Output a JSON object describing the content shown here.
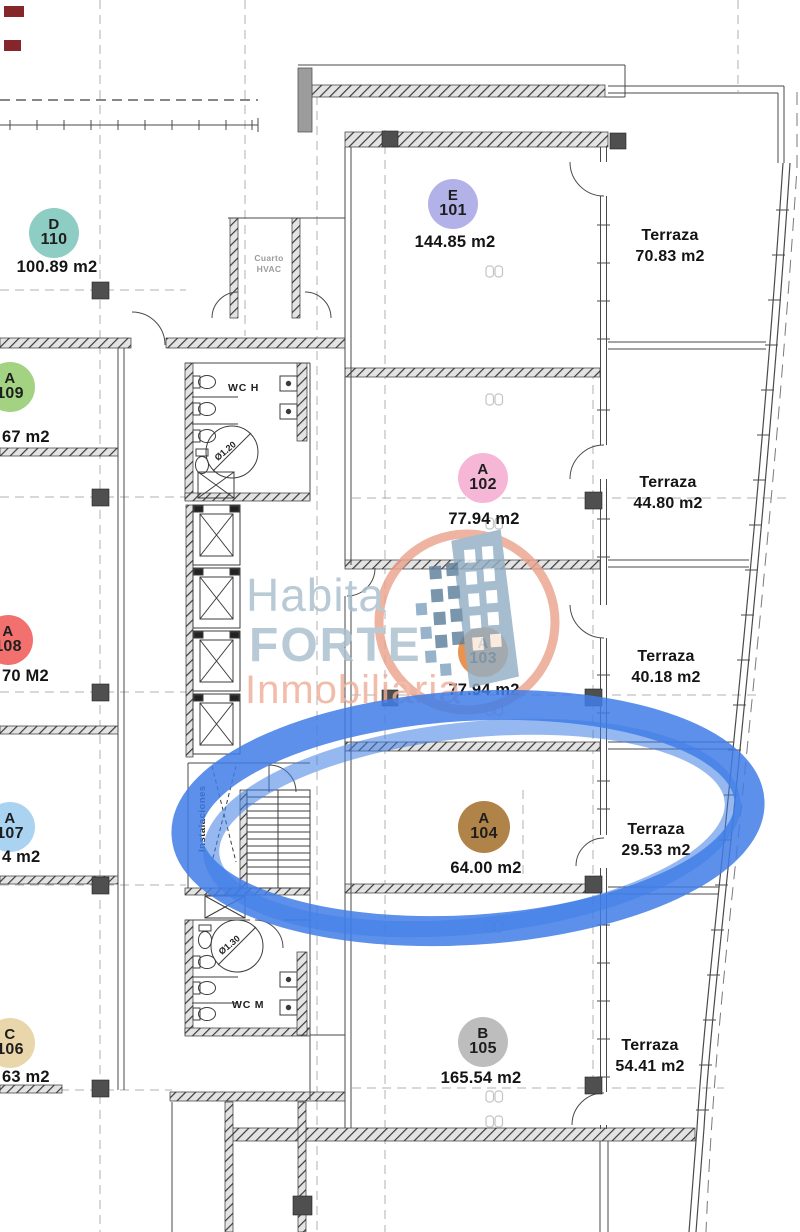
{
  "watermark": {
    "line1": "Habita",
    "line2": "FORTE",
    "line3": "Inmobiliaria"
  },
  "units": [
    {
      "letter": "D",
      "number": "110",
      "area": "100.89 m2",
      "color": "#8ecdc3"
    },
    {
      "letter": "E",
      "number": "101",
      "area": "144.85 m2",
      "color": "#b3b2e8"
    },
    {
      "letter": "A",
      "number": "102",
      "area": "77.94 m2",
      "color": "#f6b7d7"
    },
    {
      "letter": "A",
      "number": "103",
      "area": "77.94 m2",
      "color": "#ea9350"
    },
    {
      "letter": "A",
      "number": "104",
      "area": "64.00 m2",
      "color": "#b08348"
    },
    {
      "letter": "B",
      "number": "105",
      "area": "165.54 m2",
      "color": "#bdbdbd"
    },
    {
      "letter": "C",
      "number": "106",
      "area": "63 m2",
      "color": "#e9d7ab"
    },
    {
      "letter": "A",
      "number": "107",
      "area": "4 m2",
      "color": "#aad3f2"
    },
    {
      "letter": "A",
      "number": "108",
      "area": "70 M2",
      "color": "#f2716e"
    },
    {
      "letter": "A",
      "number": "109",
      "area": "67 m2",
      "color": "#a3d283"
    }
  ],
  "terraces": [
    {
      "label": "Terraza",
      "area": "70.83 m2"
    },
    {
      "label": "Terraza",
      "area": "44.80 m2"
    },
    {
      "label": "Terraza",
      "area": "40.18 m2"
    },
    {
      "label": "Terraza",
      "area": "29.53 m2"
    },
    {
      "label": "Terraza",
      "area": "54.41 m2"
    }
  ],
  "core": {
    "wc_h": "WC H",
    "wc_m": "WC M",
    "hvac_line1": "Cuarto",
    "hvac_line2": "HVAC",
    "instalaciones": "Instalaciones",
    "dim_h": "Ø1.20",
    "dim_m": "Ø1.30"
  },
  "highlight": {
    "color": "#3f7de6",
    "highlighted_unit": "104"
  }
}
